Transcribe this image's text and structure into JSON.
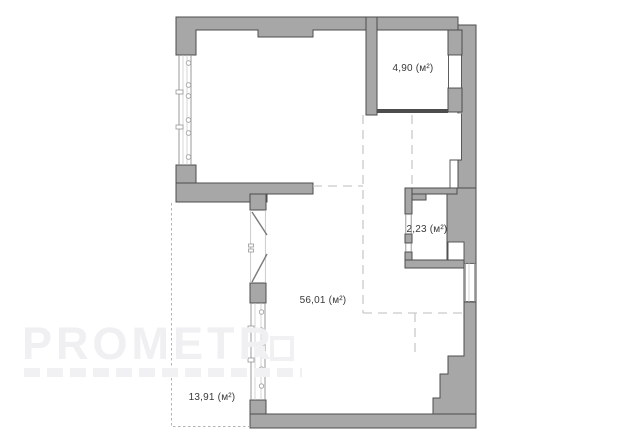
{
  "plan": {
    "type": "apartment-floor-plan",
    "rooms": [
      {
        "id": "room-top-right",
        "area_label": "4,90 (м²)"
      },
      {
        "id": "room-right-small",
        "area_label": "2,23 (м²)"
      },
      {
        "id": "room-main",
        "area_label": "56,01 (м²)"
      },
      {
        "id": "balcony",
        "area_label": "13,91 (м²)"
      }
    ],
    "watermark": {
      "text": "PROMETR"
    },
    "colors": {
      "wall_fill": "#a7a7a7",
      "wall_outline": "#4d4d4d",
      "zone_dashed_line": "#c9c9c9",
      "balcony_dashed_line": "#b3b3b3",
      "window_line": "#8f8f8f",
      "label_text": "#3a3a3a",
      "watermark": "#f0eff1",
      "background": "#ffffff"
    }
  }
}
